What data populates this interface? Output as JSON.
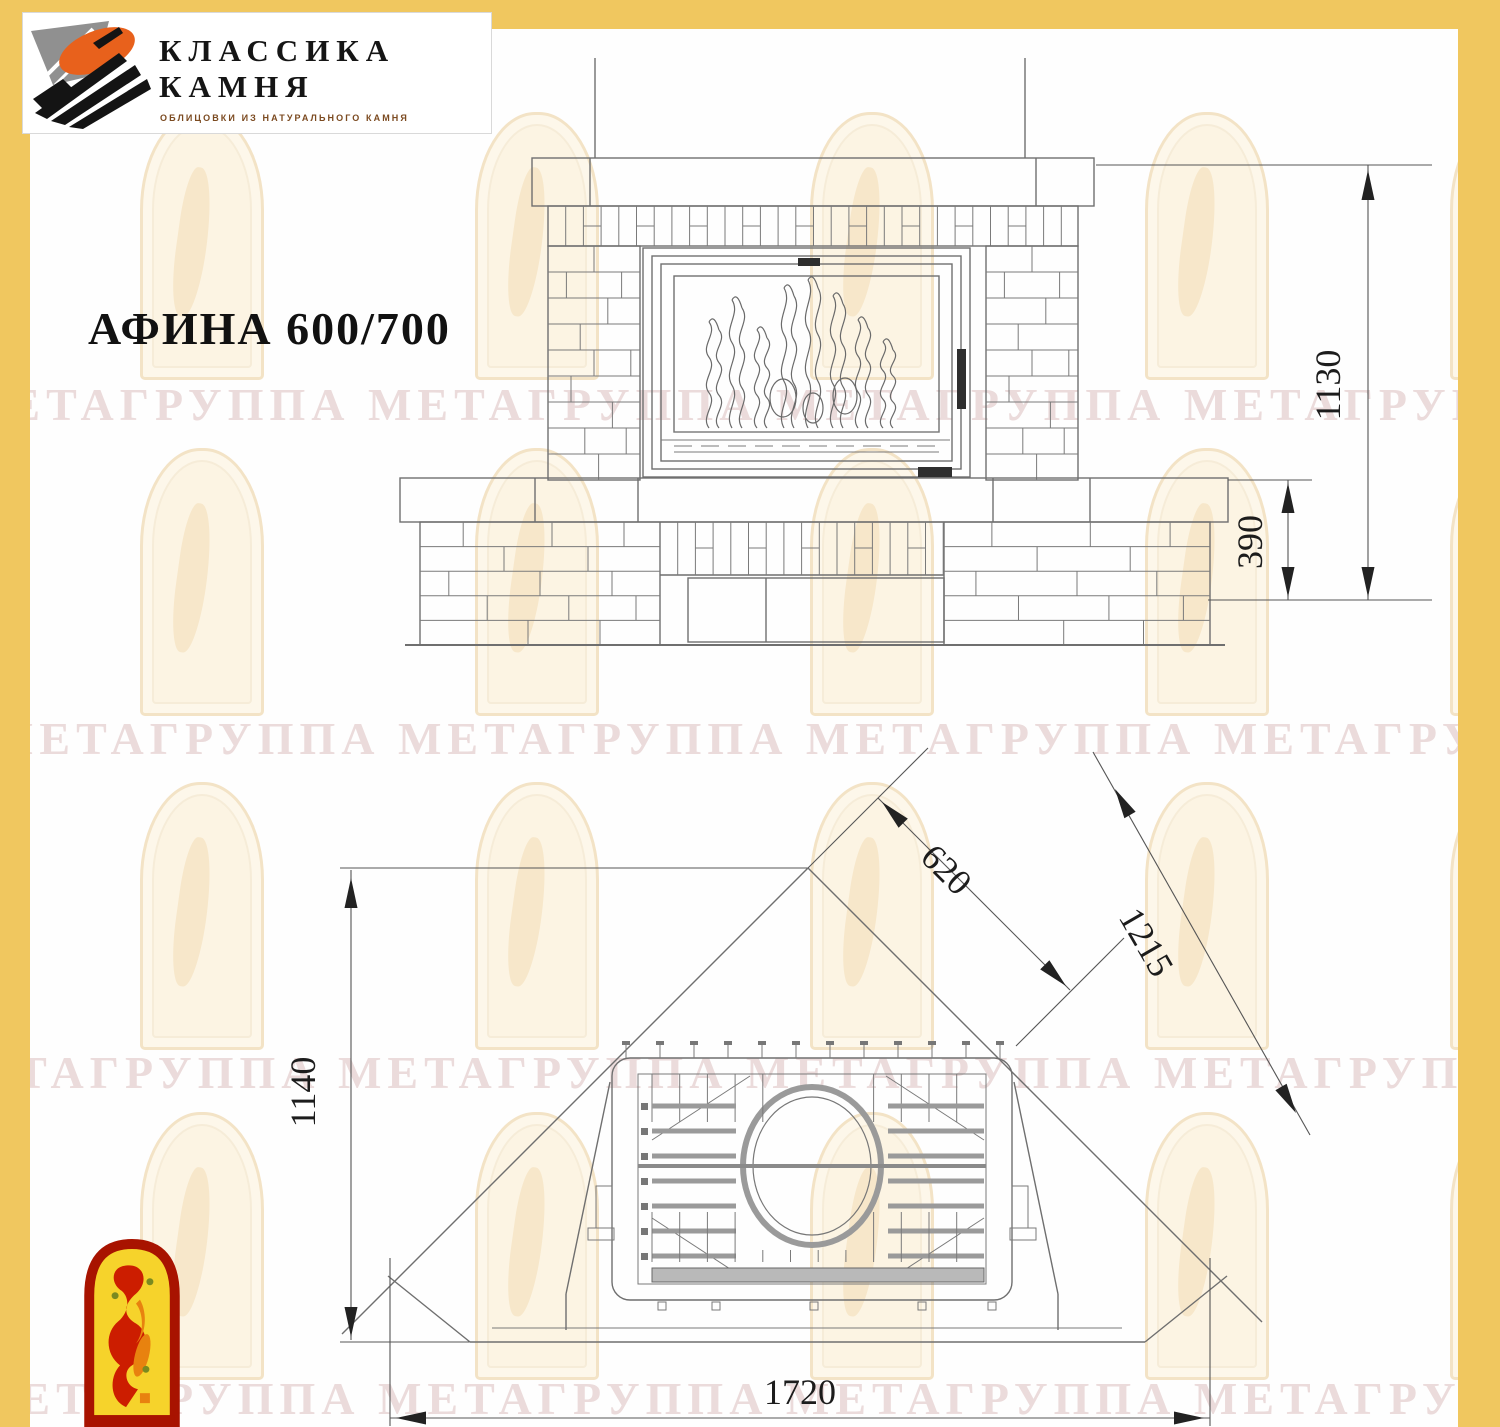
{
  "brand": {
    "name_line1": "КЛАССИКА",
    "name_line2": "КАМНЯ",
    "tagline": "ОБЛИЦОВКИ ИЗ НАТУРАЛЬНОГО КАМНЯ"
  },
  "title": "АФИНА 600/700",
  "watermark": {
    "row_text": "МЕТАГРУППА МЕТАГРУППА МЕТАГРУППА МЕТАГРУППА МЕТА"
  },
  "front_view": {
    "dimensions": {
      "total_height": "1130",
      "base_height": "390"
    }
  },
  "plan_view": {
    "dimensions": {
      "depth": "1140",
      "inner_width": "620",
      "diagonal": "1215",
      "overall_width": "1720"
    }
  },
  "colors": {
    "frame_yellow": "#f0c75f",
    "logo_orange": "#e8611c",
    "logo_gray": "#909090",
    "badge_red": "#a81300",
    "badge_yellow": "#f6d32b",
    "line_gray": "#6f6f6f"
  }
}
